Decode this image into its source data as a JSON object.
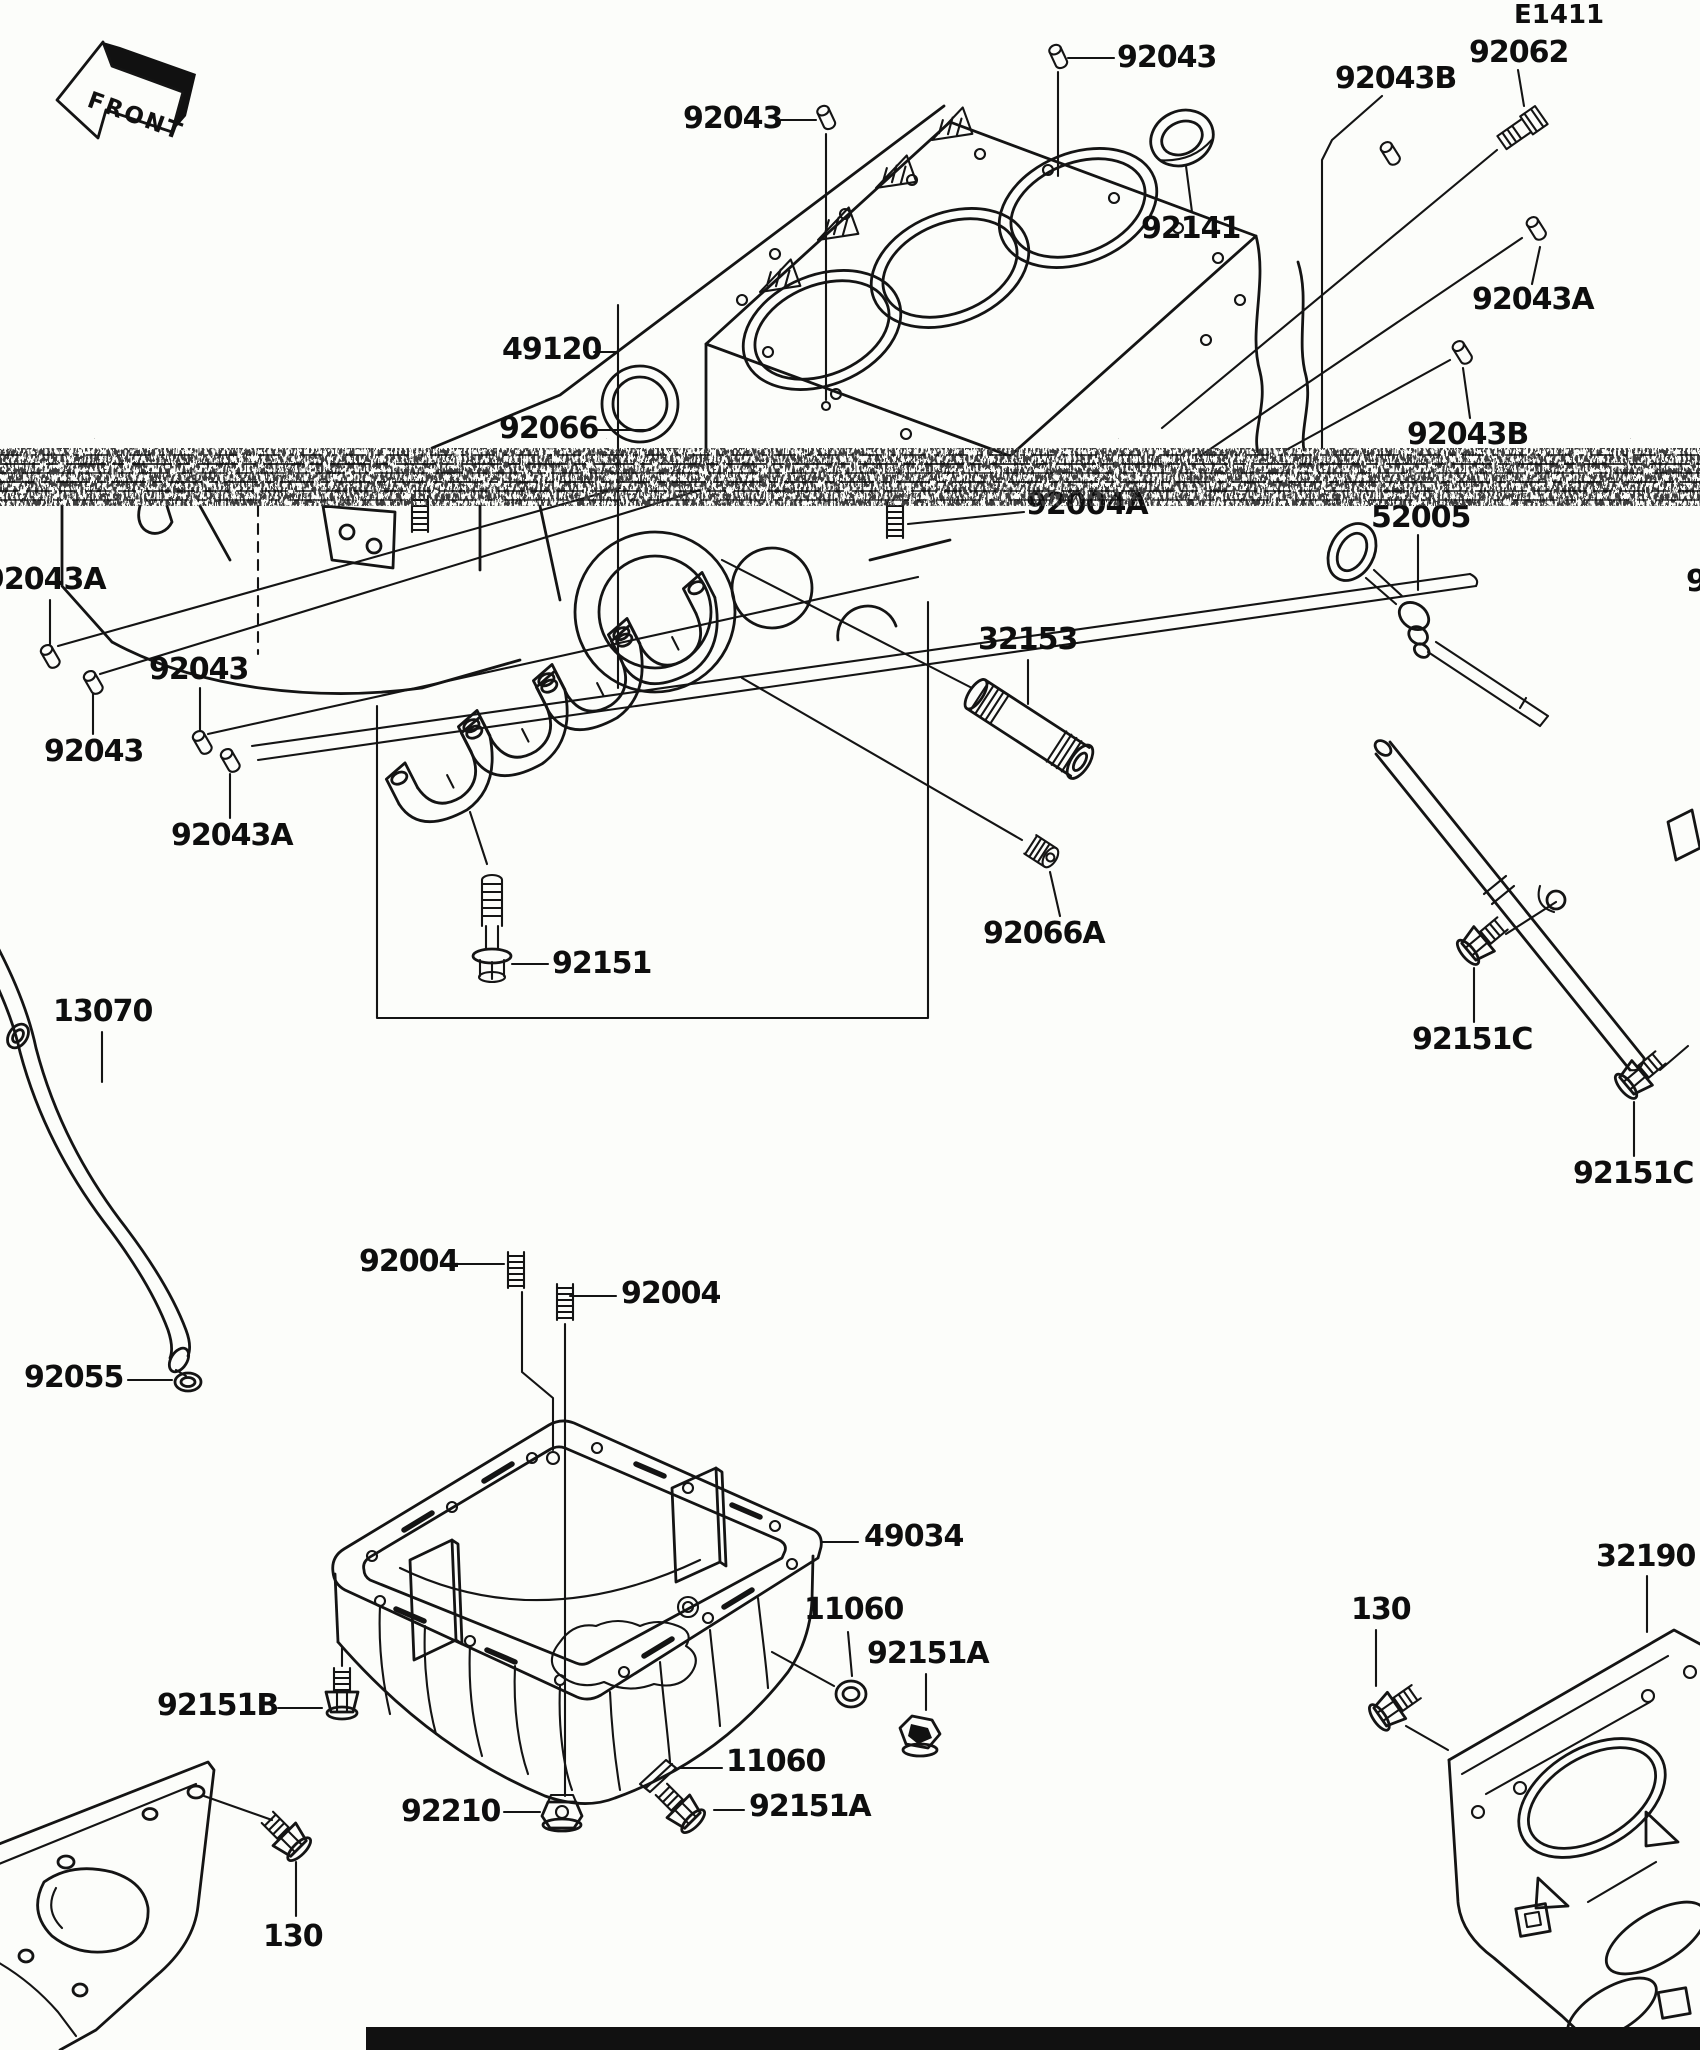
{
  "page": {
    "diagram_code": "E1411",
    "background_color": "#fcfdfa",
    "line_color": "#141414",
    "artifact": "horizontal-scan-noise-band"
  },
  "front_arrow": {
    "label": "FRONT"
  },
  "labels": [
    {
      "id": "diagram-code",
      "text": "E1411",
      "x": 1514,
      "y": 2,
      "small": true
    },
    {
      "id": "92043-top-left",
      "text": "92043",
      "x": 683,
      "y": 104
    },
    {
      "id": "92043-top-right",
      "text": "92043",
      "x": 1117,
      "y": 43
    },
    {
      "id": "92043B-top",
      "text": "92043B",
      "x": 1335,
      "y": 64
    },
    {
      "id": "92062",
      "text": "92062",
      "x": 1469,
      "y": 38
    },
    {
      "id": "92141",
      "text": "92141",
      "x": 1141,
      "y": 214
    },
    {
      "id": "92043A-right",
      "text": "92043A",
      "x": 1472,
      "y": 285
    },
    {
      "id": "92043B-right",
      "text": "92043B",
      "x": 1407,
      "y": 420
    },
    {
      "id": "49120",
      "text": "49120",
      "x": 502,
      "y": 335
    },
    {
      "id": "92066",
      "text": "92066",
      "x": 499,
      "y": 414
    },
    {
      "id": "92004A",
      "text": "92004A",
      "x": 1026,
      "y": 490
    },
    {
      "id": "52005",
      "text": "52005",
      "x": 1371,
      "y": 503
    },
    {
      "id": "92043A-left-edge",
      "text": "92043A",
      "x": -16,
      "y": 565
    },
    {
      "id": "cut-right-edge",
      "text": "9",
      "x": 1686,
      "y": 567
    },
    {
      "id": "92043-left-upper",
      "text": "92043",
      "x": 149,
      "y": 655
    },
    {
      "id": "92043-left-lower",
      "text": "92043",
      "x": 44,
      "y": 737
    },
    {
      "id": "32153",
      "text": "32153",
      "x": 978,
      "y": 625
    },
    {
      "id": "92043A-center",
      "text": "92043A",
      "x": 171,
      "y": 821
    },
    {
      "id": "92066A",
      "text": "92066A",
      "x": 983,
      "y": 919
    },
    {
      "id": "92151",
      "text": "92151",
      "x": 552,
      "y": 949
    },
    {
      "id": "13070",
      "text": "13070",
      "x": 53,
      "y": 997
    },
    {
      "id": "92151C-upper",
      "text": "92151C",
      "x": 1412,
      "y": 1025
    },
    {
      "id": "92151C-lower",
      "text": "92151C",
      "x": 1573,
      "y": 1159
    },
    {
      "id": "92004-left",
      "text": "92004",
      "x": 359,
      "y": 1247
    },
    {
      "id": "92004-right",
      "text": "92004",
      "x": 621,
      "y": 1279
    },
    {
      "id": "92055",
      "text": "92055",
      "x": 24,
      "y": 1363
    },
    {
      "id": "49034",
      "text": "49034",
      "x": 864,
      "y": 1522
    },
    {
      "id": "32190",
      "text": "32190",
      "x": 1596,
      "y": 1542
    },
    {
      "id": "130-right",
      "text": "130",
      "x": 1351,
      "y": 1595
    },
    {
      "id": "11060-upper",
      "text": "11060",
      "x": 804,
      "y": 1595
    },
    {
      "id": "92151A-upper",
      "text": "92151A",
      "x": 867,
      "y": 1639
    },
    {
      "id": "92151B",
      "text": "92151B",
      "x": 157,
      "y": 1691
    },
    {
      "id": "11060-lower",
      "text": "11060",
      "x": 726,
      "y": 1747
    },
    {
      "id": "92210",
      "text": "92210",
      "x": 401,
      "y": 1797
    },
    {
      "id": "92151A-lower",
      "text": "92151A",
      "x": 749,
      "y": 1792
    },
    {
      "id": "130-left",
      "text": "130",
      "x": 263,
      "y": 1922
    }
  ]
}
